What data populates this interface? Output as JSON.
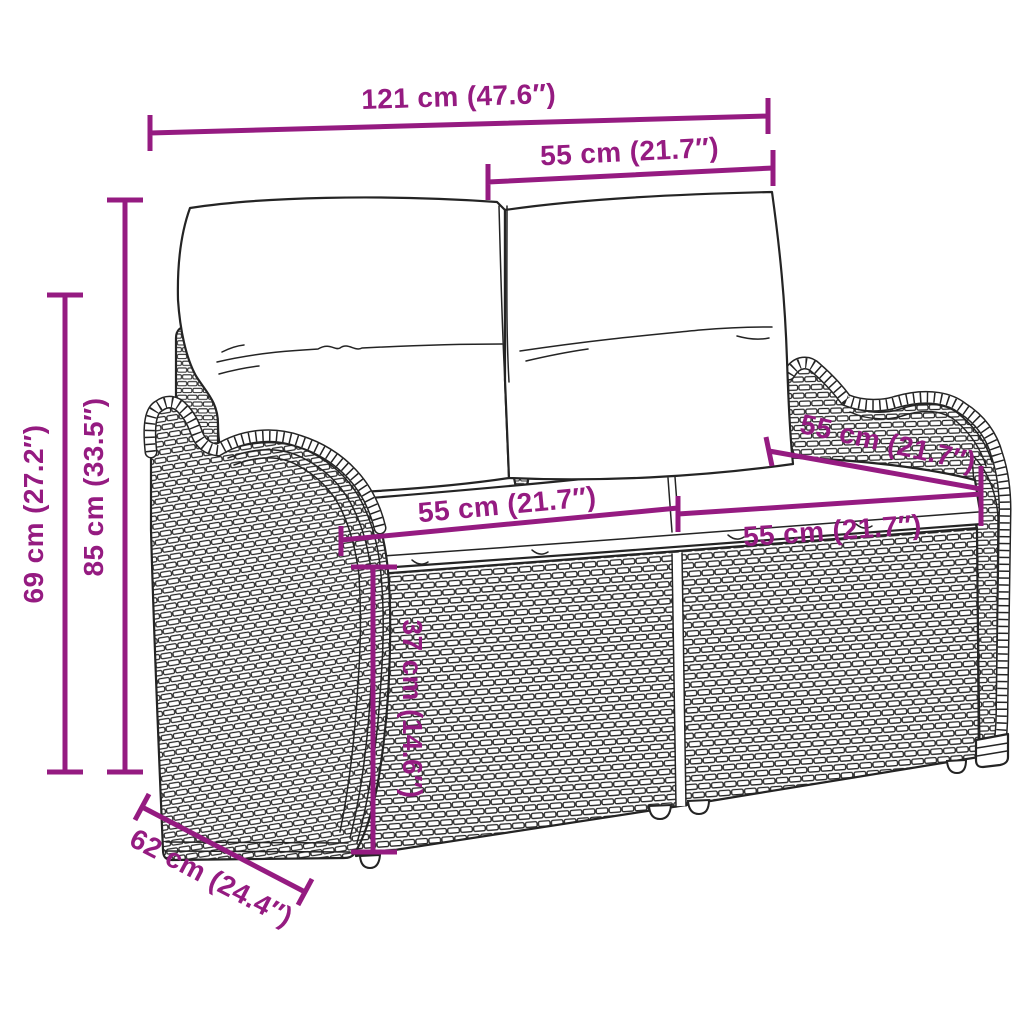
{
  "diagram": {
    "type": "product-dimension-diagram",
    "subject": "poly rattan 2-seater garden sofa with back and seat cushions",
    "colors": {
      "accent": "#951b81",
      "line_art": "#242424",
      "background": "#ffffff"
    },
    "dim_labels": {
      "overall_width": "121 cm (47.6″)",
      "back_cushion_width": "55 cm (21.7″)",
      "back_height": "85 cm (33.5″)",
      "arm_height": "69 cm (27.2″)",
      "seat_width_left": "55 cm (21.7″)",
      "seat_width_right": "55 cm (21.7″)",
      "seat_depth": "55 cm (21.7″)",
      "seat_height": "37 cm (14.6″)",
      "overall_depth": "62 cm (24.4″)"
    }
  }
}
